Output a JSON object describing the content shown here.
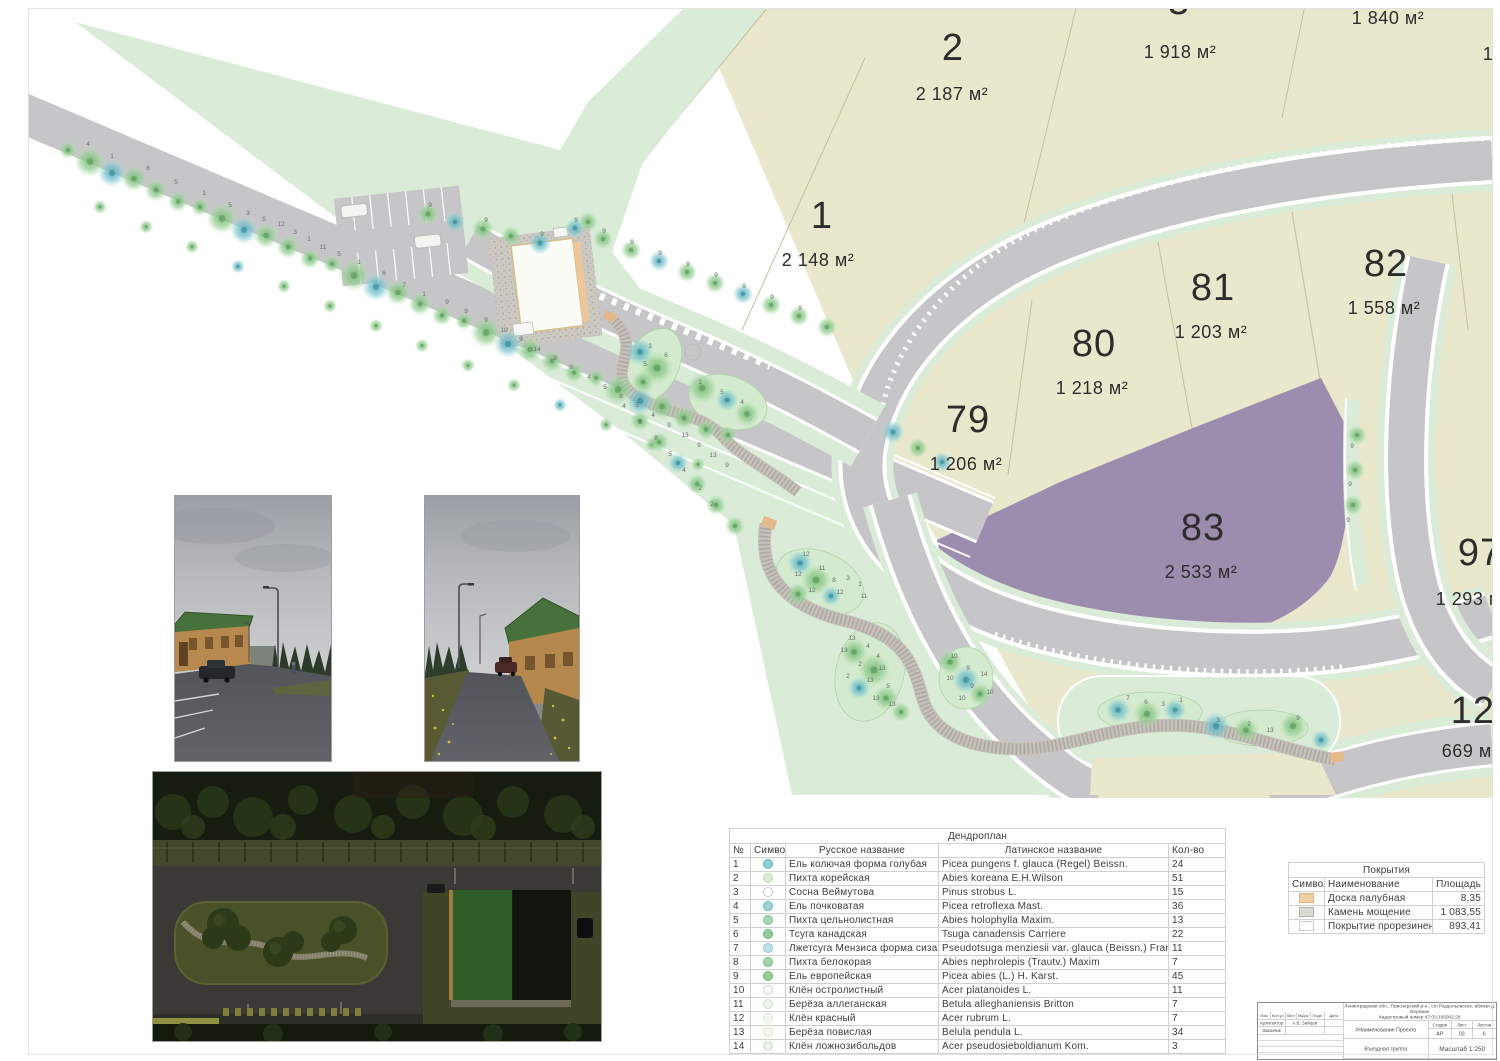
{
  "palette": {
    "parcel_beige": "#eae8cc",
    "landscape_green": "#daecd8",
    "road_gray": "#c6c6c8",
    "highlight_purple": "#9c8cad",
    "bed_green": "#d4ebcf"
  },
  "plan": {
    "parcels": [
      {
        "id": "1",
        "number": "1",
        "area": "2 148 м²"
      },
      {
        "id": "2",
        "number": "2",
        "area": "2 187 м²"
      },
      {
        "id": "3",
        "number": "3",
        "area": "1 918 м²"
      },
      {
        "id": "top-right",
        "number": "",
        "area": "1 840 м²"
      },
      {
        "id": "79",
        "number": "79",
        "area": "1 206 м²"
      },
      {
        "id": "80",
        "number": "80",
        "area": "1 218 м²"
      },
      {
        "id": "81",
        "number": "81",
        "area": "1 203 м²"
      },
      {
        "id": "82",
        "number": "82",
        "area": "1 558 м²"
      },
      {
        "id": "83",
        "number": "83",
        "area": "2 533 м²"
      },
      {
        "id": "97",
        "number": "97",
        "area": "1 293 м²"
      },
      {
        "id": "120",
        "number": "120",
        "area": "669 м²"
      }
    ],
    "edge_fragment": "1",
    "tree_labels": [
      [
        88,
        146,
        "4"
      ],
      [
        112,
        158,
        "1"
      ],
      [
        148,
        170,
        "6"
      ],
      [
        176,
        184,
        "5"
      ],
      [
        204,
        195,
        "1"
      ],
      [
        230,
        207,
        "5"
      ],
      [
        248,
        215,
        "3"
      ],
      [
        264,
        221,
        "5"
      ],
      [
        281,
        226,
        "12"
      ],
      [
        295,
        234,
        "3"
      ],
      [
        309,
        241,
        "1"
      ],
      [
        323,
        249,
        "11"
      ],
      [
        339,
        256,
        "5"
      ],
      [
        359,
        264,
        "1"
      ],
      [
        384,
        275,
        "6"
      ],
      [
        404,
        287,
        "7"
      ],
      [
        424,
        296,
        "1"
      ],
      [
        447,
        304,
        "9"
      ],
      [
        466,
        313,
        "9"
      ],
      [
        486,
        322,
        "9"
      ],
      [
        504,
        332,
        "10"
      ],
      [
        521,
        341,
        "9"
      ],
      [
        537,
        351,
        "14"
      ],
      [
        555,
        360,
        "9"
      ],
      [
        571,
        369,
        "9"
      ],
      [
        589,
        379,
        "4"
      ],
      [
        605,
        389,
        "5"
      ],
      [
        621,
        398,
        "8"
      ],
      [
        637,
        407,
        "5"
      ],
      [
        653,
        417,
        "4"
      ],
      [
        669,
        427,
        "9"
      ],
      [
        685,
        437,
        "13"
      ],
      [
        699,
        447,
        "9"
      ],
      [
        713,
        457,
        "13"
      ],
      [
        727,
        467,
        "9"
      ],
      [
        576,
        222,
        "9"
      ],
      [
        604,
        233,
        "9"
      ],
      [
        632,
        244,
        "9"
      ],
      [
        660,
        255,
        "9"
      ],
      [
        688,
        266,
        "9"
      ],
      [
        716,
        277,
        "9"
      ],
      [
        744,
        288,
        "9"
      ],
      [
        772,
        299,
        "9"
      ],
      [
        800,
        310,
        "9"
      ],
      [
        430,
        207,
        "9"
      ],
      [
        486,
        222,
        "9"
      ],
      [
        542,
        236,
        "9"
      ],
      [
        650,
        348,
        "3"
      ],
      [
        666,
        357,
        "6"
      ],
      [
        645,
        366,
        "5"
      ],
      [
        700,
        384,
        "1"
      ],
      [
        722,
        394,
        "5"
      ],
      [
        742,
        404,
        "4"
      ],
      [
        806,
        556,
        "12"
      ],
      [
        822,
        570,
        "11"
      ],
      [
        798,
        576,
        "12"
      ],
      [
        834,
        582,
        "8"
      ],
      [
        848,
        580,
        "3"
      ],
      [
        860,
        586,
        "1"
      ],
      [
        812,
        592,
        "12"
      ],
      [
        840,
        594,
        "12"
      ],
      [
        864,
        598,
        "11"
      ],
      [
        852,
        640,
        "13"
      ],
      [
        868,
        648,
        "4"
      ],
      [
        844,
        652,
        "13"
      ],
      [
        878,
        658,
        "4"
      ],
      [
        860,
        666,
        "2"
      ],
      [
        882,
        670,
        "13"
      ],
      [
        848,
        678,
        "2"
      ],
      [
        870,
        682,
        "13"
      ],
      [
        888,
        688,
        "5"
      ],
      [
        876,
        700,
        "13"
      ],
      [
        892,
        706,
        "13"
      ],
      [
        954,
        658,
        "10"
      ],
      [
        968,
        670,
        "9"
      ],
      [
        984,
        676,
        "14"
      ],
      [
        950,
        680,
        "10"
      ],
      [
        972,
        688,
        "9"
      ],
      [
        990,
        694,
        "10"
      ],
      [
        962,
        700,
        "10"
      ],
      [
        1128,
        700,
        "7"
      ],
      [
        1146,
        704,
        "6"
      ],
      [
        1163,
        706,
        "3"
      ],
      [
        1181,
        702,
        "1"
      ],
      [
        1218,
        722,
        "3"
      ],
      [
        1249,
        726,
        "2"
      ],
      [
        1298,
        720,
        "9"
      ],
      [
        1270,
        732,
        "13"
      ],
      [
        624,
        408,
        "4"
      ],
      [
        640,
        424,
        "5"
      ],
      [
        656,
        440,
        "8"
      ],
      [
        670,
        456,
        "5"
      ],
      [
        684,
        472,
        "4"
      ],
      [
        700,
        490,
        "2"
      ],
      [
        712,
        506,
        "2"
      ],
      [
        1352,
        448,
        "9"
      ],
      [
        1350,
        486,
        "9"
      ],
      [
        1348,
        522,
        "9"
      ]
    ]
  },
  "dendroplan": {
    "title": "Дендроплан",
    "headers": {
      "num": "№",
      "symbol": "Символ",
      "russian": "Русское название",
      "latin": "Латинское название",
      "qty": "Кол-во"
    },
    "rows": [
      {
        "num": "1",
        "ru": "Ель колючая форма голубая",
        "la": "Picea pungens f. glauca (Regel) Beissn.",
        "qty": "24",
        "color": "#8ecdd3",
        "stroke": "#5fb2bb"
      },
      {
        "num": "2",
        "ru": "Пихта корейская",
        "la": "Abies koreana E.H.Wilson",
        "qty": "51",
        "color": "#d9ecd4",
        "stroke": "#b9d8b0"
      },
      {
        "num": "3",
        "ru": "Сосна Веймутова",
        "la": "Pinus strobus L.",
        "qty": "15",
        "color": "#ffffff",
        "stroke": "#c9c9c9"
      },
      {
        "num": "4",
        "ru": "Ель почковатая",
        "la": "Picea retroflexa Mast.",
        "qty": "36",
        "color": "#9ad2d6",
        "stroke": "#6ab4bc"
      },
      {
        "num": "5",
        "ru": "Пихта цельнолистная",
        "la": "Abies holophylla Maxim.",
        "qty": "13",
        "color": "#a9d8b2",
        "stroke": "#7fc08c"
      },
      {
        "num": "6",
        "ru": "Тсуга канадская",
        "la": "Tsuga canadensis Carriere",
        "qty": "22",
        "color": "#8fcc9c",
        "stroke": "#66b377"
      },
      {
        "num": "7",
        "ru": "Лжетсуга Мензиса форма сизая",
        "la": "Pseudotsuga menziesii var. glauca (Beissn.) Franco",
        "qty": "11",
        "color": "#bfe0e8",
        "stroke": "#93c5d1"
      },
      {
        "num": "8",
        "ru": "Пихта белокорая",
        "la": "Abies nephrolepis (Trautv.) Maxim",
        "qty": "7",
        "color": "#a3d4a9",
        "stroke": "#79bb83"
      },
      {
        "num": "9",
        "ru": "Ель европейская",
        "la": "Picea abies (L.) H. Karst.",
        "qty": "45",
        "color": "#97ce97",
        "stroke": "#6fb56f"
      },
      {
        "num": "10",
        "ru": "Клён остролистный",
        "la": "Acer platanoides L.",
        "qty": "11",
        "color": "#ffffff",
        "stroke": "#cccccc"
      },
      {
        "num": "11",
        "ru": "Берёза аллеганская",
        "la": "Betula alleghaniensis Britton",
        "qty": "7",
        "color": "#eef5ea",
        "stroke": "#cfe0c8"
      },
      {
        "num": "12",
        "ru": "Клён красный",
        "la": "Acer rubrum L.",
        "qty": "7",
        "color": "#f2f7f0",
        "stroke": "#d5e3d0"
      },
      {
        "num": "13",
        "ru": "Берёза повислая",
        "la": "Belula pendula L.",
        "qty": "34",
        "color": "#f0f6ee",
        "stroke": "#d2e2cc"
      },
      {
        "num": "14",
        "ru": "Клён ложнозибольдов",
        "la": "Acer pseudosieboldianum Kom.",
        "qty": "3",
        "color": "#e8f2e4",
        "stroke": "#c8dcc0"
      }
    ]
  },
  "coverings": {
    "title": "Покрытия",
    "headers": {
      "symbol": "Символ",
      "name": "Наименование",
      "area": "Площадь"
    },
    "rows": [
      {
        "name": "Доска палубная",
        "area": "8,35",
        "color": "#f0cfa0",
        "stroke": "#ddb67f"
      },
      {
        "name": "Камень мощение",
        "area": "1 083,55",
        "color": "#dcdad5",
        "stroke": "#b4b1ab"
      },
      {
        "name": "Покрытие прорезиненное",
        "area": "893,41",
        "color": "#ffffff",
        "stroke": "#cccccc"
      }
    ]
  },
  "title_block": {
    "address_line1": "Ленинградская обл., Приозерский р-н., с/п Раздольевское, вблизи д. Бережки",
    "address_line2": "Кадастровый номер 47:03:105002:29",
    "columns": [
      "Изм",
      "Кол.уч",
      "Лист",
      "№Док",
      "Подп",
      "Дата"
    ],
    "architect_role": "Архитектор",
    "architect_name": "А.В. Зайцев",
    "client_role": "Заказчик",
    "project_name": "#Наименование Проекта",
    "stage_label": "Стадия",
    "sheet_label": "Лист",
    "sheets_label": "Листов",
    "stage": "АР",
    "sheet": "03",
    "sheets": "6",
    "drawing_title": "Въездная группа",
    "scale": "Масштаб 1:250"
  }
}
